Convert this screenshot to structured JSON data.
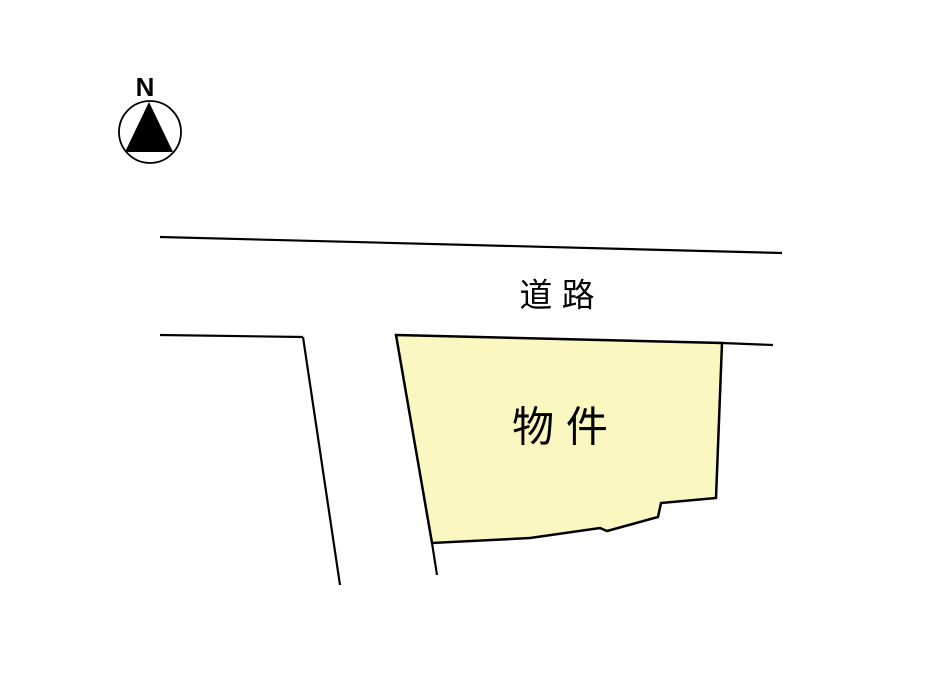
{
  "compass": {
    "label": "N"
  },
  "labels": {
    "road": "道 路",
    "property": "物 件"
  },
  "colors": {
    "background": "#FFFFFF",
    "line": "#000000",
    "parcel_fill": "#FAF7C0"
  },
  "geometry": {
    "compass": {
      "cx": 150,
      "cy": 132,
      "r": 31,
      "needle_points": "149,102 125,152 173,152",
      "label_x": 145,
      "label_y": 87,
      "label_font_size": 26
    },
    "roads": [
      {
        "name": "road-edge-top",
        "points": "160,237 782,253"
      },
      {
        "name": "road-edge-left-horizontal",
        "points": "160,335 303,337"
      },
      {
        "name": "road-edge-left-vertical",
        "points": "303,337 340,585"
      },
      {
        "name": "road-edge-right",
        "points": "722,343 773,345"
      },
      {
        "name": "parcel-boundary-extension",
        "points": "432,543 437,575"
      }
    ],
    "parcel_points": "396,335 722,343 716,498 661,503 658,517 607,531 600,528 530,538 432,543",
    "road_label": {
      "x": 557,
      "y": 295,
      "font_size": 33
    },
    "property_label": {
      "x": 560,
      "y": 427,
      "font_size": 42
    }
  }
}
